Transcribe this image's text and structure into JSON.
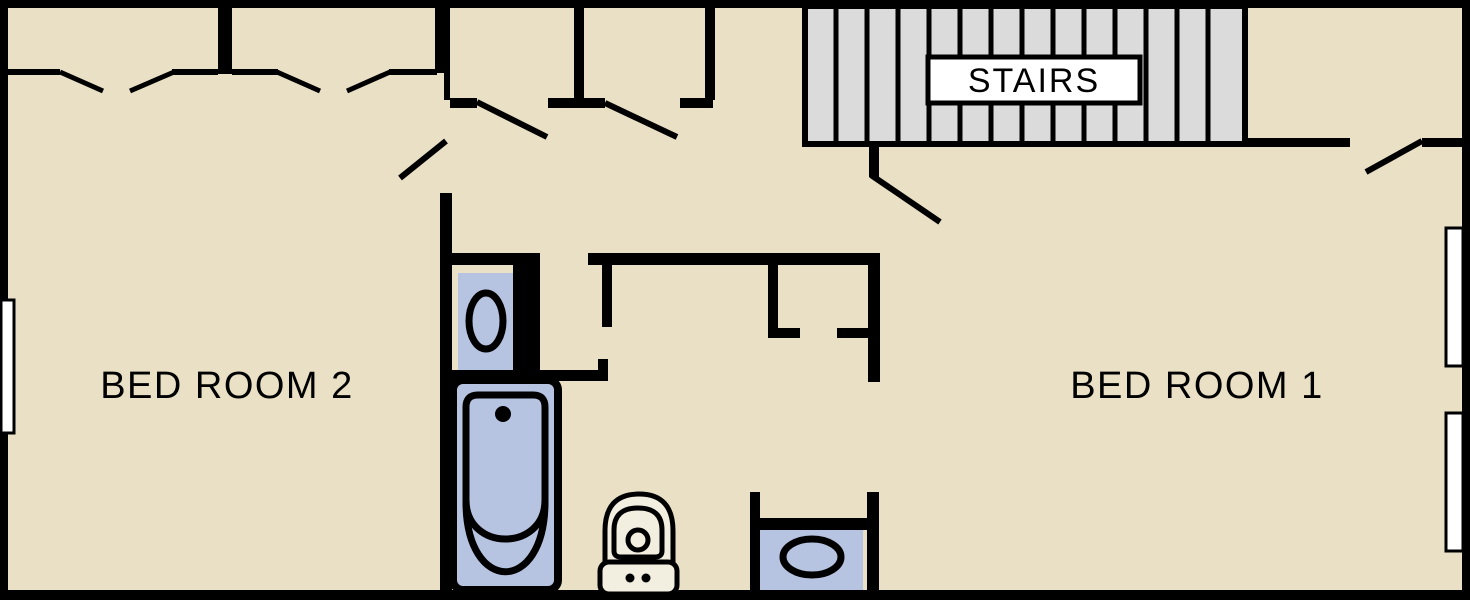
{
  "plan": {
    "type": "floor-plan",
    "rooms": {
      "bedroom2": {
        "label": "BED ROOM 2"
      },
      "bedroom1": {
        "label": "BED ROOM 1"
      },
      "stairs": {
        "label": "STAIRS"
      }
    },
    "fixtures": {
      "top_sink": "sink-vanity",
      "bathtub": "bathtub",
      "toilet": "toilet",
      "bottom_sink": "sink-vanity"
    },
    "colors": {
      "floor": "#e9e0c6",
      "wall": "#000000",
      "fixture": "#b6c4e2",
      "stairs": "#dbdbdb",
      "window": "#ffffff",
      "label_bg": "#ffffff",
      "toilet": "#f2eee0"
    }
  }
}
